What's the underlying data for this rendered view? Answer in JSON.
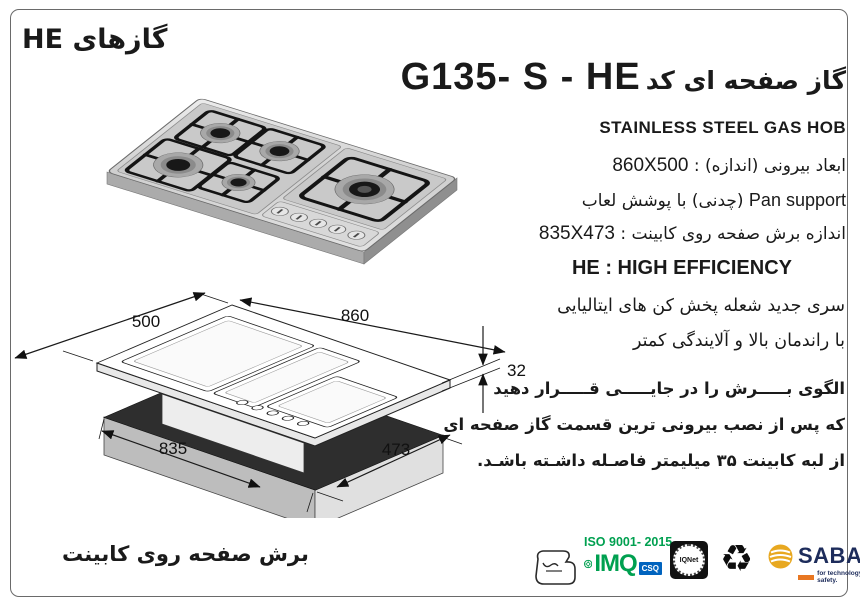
{
  "page": {
    "category_title": "گازهای HE",
    "model_title_fa": "گاز صفحه ای کد",
    "model_code": "G135- S - HE",
    "product_subtitle": "STAINLESS STEEL GAS HOB"
  },
  "specs": {
    "outer_dimensions_label": "ابعاد بیرونی (اندازه) :",
    "outer_dimensions_value": "860X500",
    "pan_support_en": "Pan support",
    "pan_support_fa": "(چدنی)  با پوشش لعاب",
    "cut_size_label": "اندازه برش صفحه روی کابینت :",
    "cut_size_value": "835X473"
  },
  "efficiency": {
    "heading": "HE : HIGH EFFICIENCY",
    "line1": "سری جدید شعله پخش کن های ایتالیایی",
    "line2": "با راندمان بالا و آلایندگی کمتر"
  },
  "note": {
    "line1": "الگوی بـــــرش را در جایـــــی قـــــرار دهید",
    "line2": "که پس از نصب بیرونی ترین قسمت گاز صفحه ای",
    "line3": "از لبه کابینت ۳۵ میلیمتر فاصـله داشـته باشـد."
  },
  "dimensions_drawing": {
    "top_width": "500",
    "top_length": "860",
    "thickness": "32",
    "cut_length": "835",
    "cut_width": "473"
  },
  "footer": {
    "caption": "برش صفحه روی کابینت"
  },
  "certifications": {
    "iso_label": "ISO 9001- 2015",
    "imq_label": "IMQ",
    "csq_label": "CSQ",
    "iqnet_label": "IQNet",
    "recycle_icon": "recycling-symbol",
    "sabaf_label": "SABAF",
    "sabaf_tagline": "for technology and safety."
  },
  "colors": {
    "iso_green": "#00a050",
    "csq_blue": "#0063be",
    "sabaf_navy": "#1d2c5b",
    "sabaf_gold": "#e8a820",
    "sabaf_orange": "#e87722",
    "steel_gray": "#d9d9d9"
  }
}
